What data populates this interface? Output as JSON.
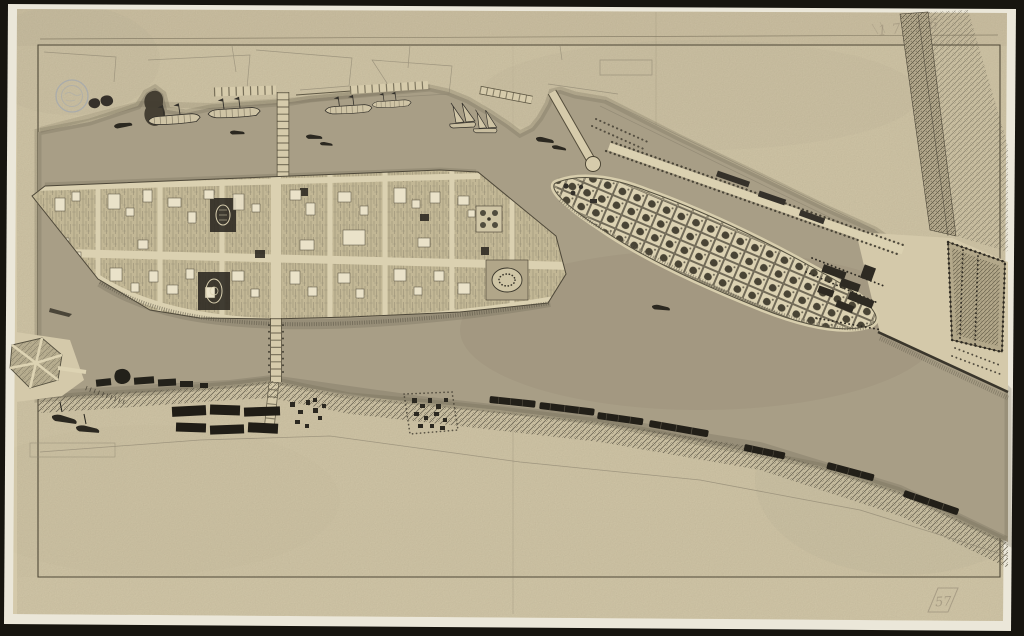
{
  "document": {
    "kind": "scanned historical manuscript map",
    "media": "ink and wash on aged laid paper, photographed on black background",
    "legible_title": ""
  },
  "annotations": {
    "pencil_top_right": "17 16",
    "pencil_bottom_right": "57",
    "stamp": {
      "shape": "circular collection stamp",
      "legible": false
    }
  },
  "features": {
    "town": "gridded town on river island with central cross streets and two bridges",
    "garden_island": "lens-shaped island of square garden plots",
    "embankment": "diagonal hatched levee at upper right",
    "river": "hatched river surrounding islands",
    "south_bank": "lower shore with timber yards, rafts and small settlements",
    "hexagon_garden": "six-part formal garden on lower-left promontory",
    "ships": "galleys and lateen-rigged vessels moored along upper shore"
  },
  "colors": {
    "bg": "#17150f",
    "deckle": "#ebe7d9",
    "paper": "#d4c9aa",
    "paper_dark": "#c8bc9d",
    "ink": "#453f2f",
    "ink_soft": "#6e6754",
    "ink_faint": "#8d8571",
    "water": "#a89e86",
    "water_line": "#5d5846",
    "block": "#c2b795",
    "street": "#dbd1b1",
    "building": "#eae2c9",
    "dark_structure": "#2b2720",
    "timber": "#201d16",
    "bank": "#57503f",
    "stamp_blue": "#93a0b6",
    "pencil": "#6b5f52"
  }
}
